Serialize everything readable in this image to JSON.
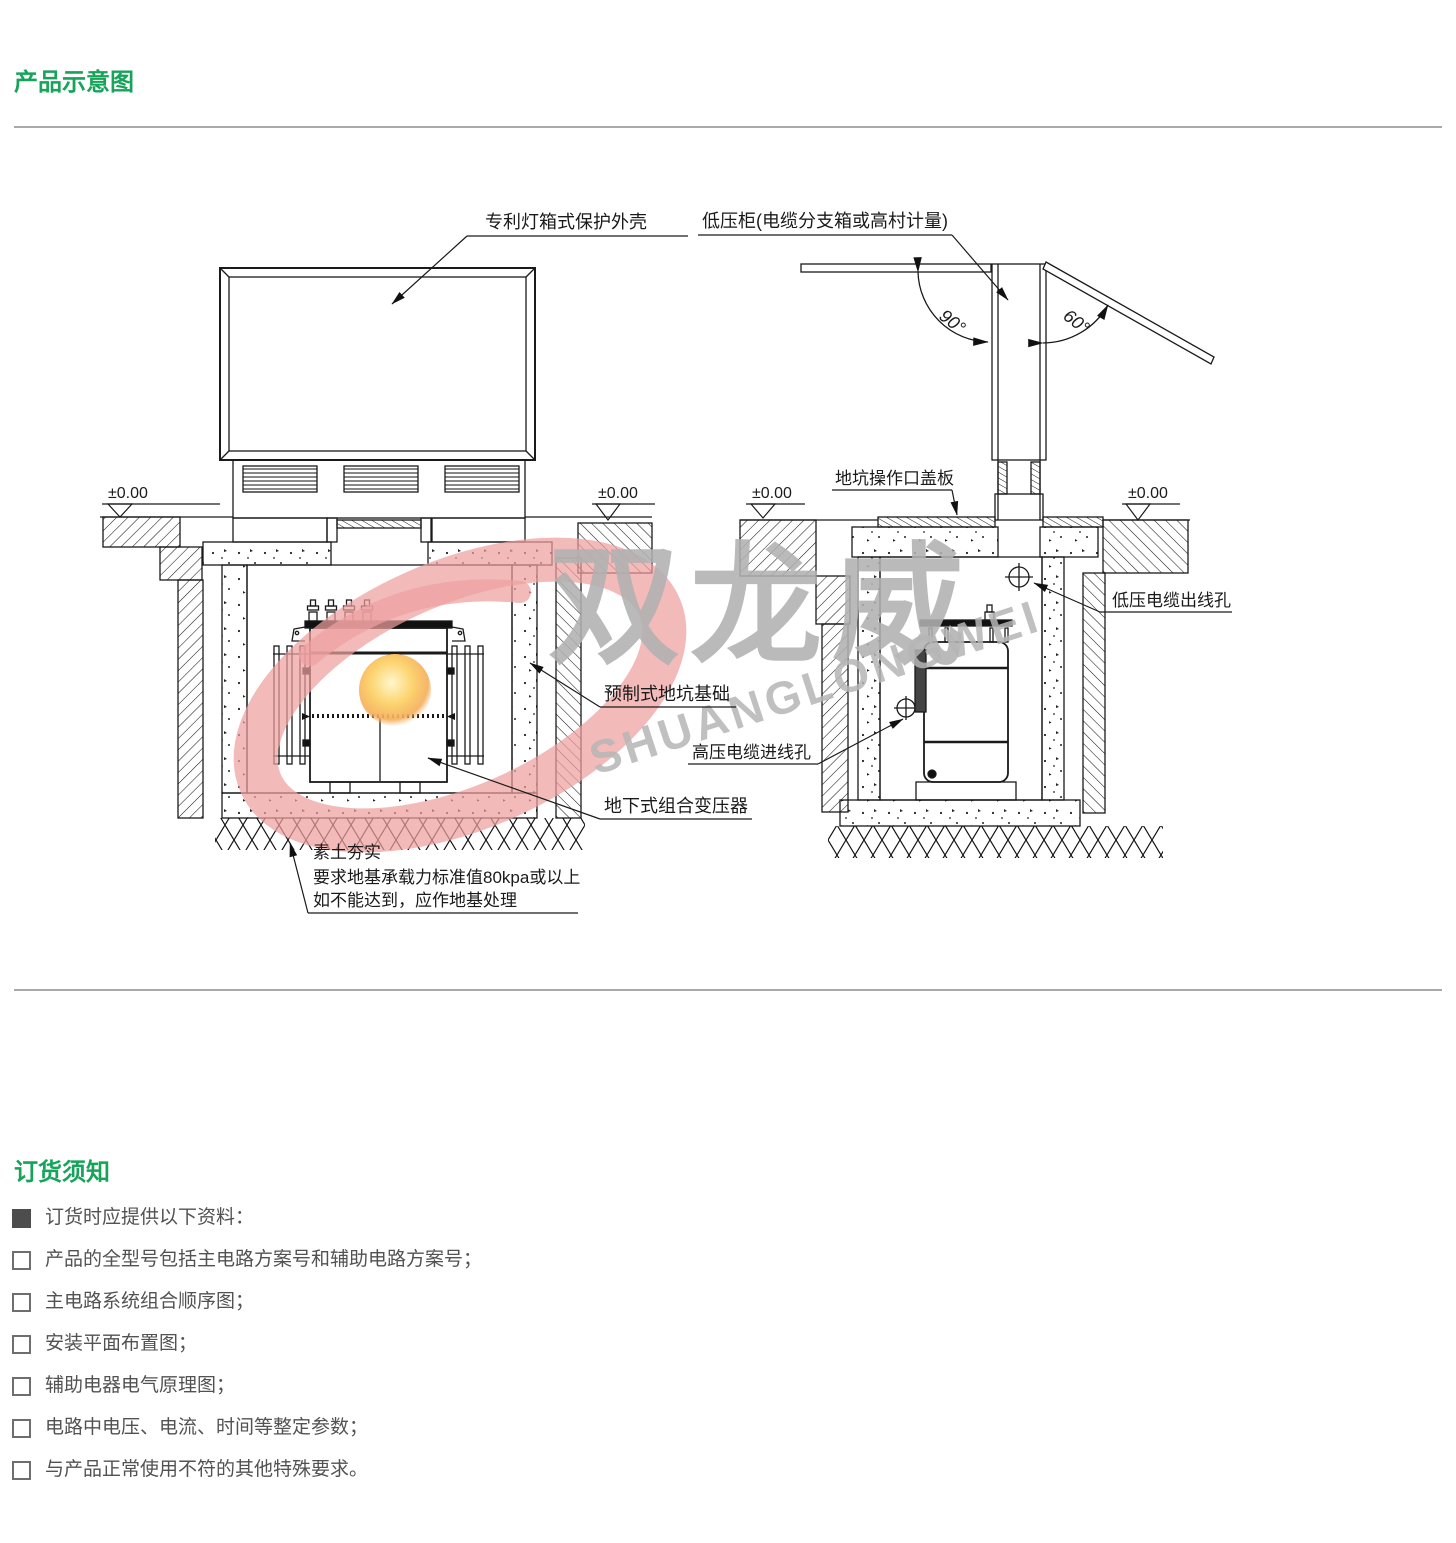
{
  "page": {
    "title_product": "产品示意图",
    "title_order": "订货须知"
  },
  "watermark": {
    "cn": "双龙威",
    "en": "SHUANGLONGWEI"
  },
  "diagram_left": {
    "label_shell": "专利灯箱式保护外壳",
    "label_foundation": "预制式地坑基础",
    "label_transformer": "地下式组合变压器",
    "soil_note_line1": "素土夯实",
    "soil_note_line2": "要求地基承载力标准值80kpa或以上",
    "soil_note_line3": "如不能达到，应作地基处理",
    "level_left": "±0.00",
    "level_right": "±0.00"
  },
  "diagram_right": {
    "label_cabinet": "低压柜(电缆分支箱或高村计量)",
    "label_cover_plate": "地坑操作口盖板",
    "label_lv_outlet": "低压电缆出线孔",
    "label_hv_inlet": "高压电缆进线孔",
    "angle_left": "90°",
    "angle_right": "60°",
    "level_left": "±0.00",
    "level_right": "±0.00"
  },
  "order_notes": {
    "intro": "订货时应提供以下资料：",
    "items": [
      "产品的全型号包括主电路方案号和辅助电路方案号；",
      "主电路系统组合顺序图；",
      "安装平面布置图；",
      " 辅助电器电气原理图；",
      "电路中电压、电流、时间等整定参数；",
      "与产品正常使用不符的其他特殊要求。"
    ]
  },
  "colors": {
    "accent_green": "#17a45a",
    "text_gray": "#4d4d4d",
    "line_black": "#1a1a1a",
    "divider_gray": "#a9a9a9",
    "watermark_gray": "#b0b0b0",
    "watermark_red": "#ef9f9f",
    "ball_orange": "#f5ab55"
  }
}
